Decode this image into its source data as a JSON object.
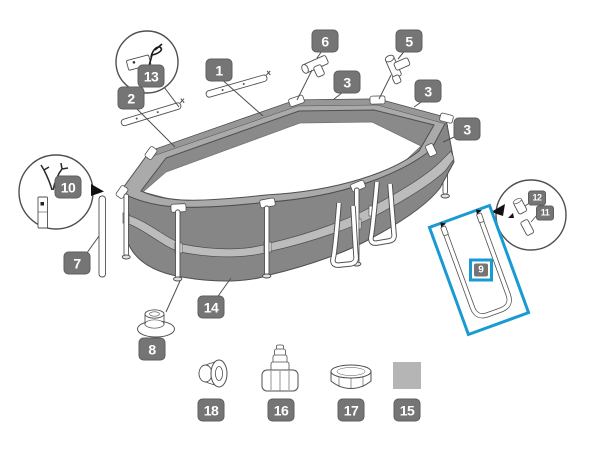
{
  "diagram": {
    "subject": "oval-frame-pool-exploded-parts-diagram",
    "background_color": "#ffffff",
    "badge_color": "#757575",
    "badge_text_color": "#ffffff",
    "line_color": "#4f4f4f",
    "wall_color": "#868686",
    "rail_color": "#aaaaaa",
    "band_color": "#bcbcbc",
    "patch_color": "#b5b5b5",
    "highlight_color": "#1a9ad2",
    "highlighted_part": "9",
    "callouts": {
      "c1": {
        "label": "1"
      },
      "c2": {
        "label": "2"
      },
      "c3a": {
        "label": "3"
      },
      "c3b": {
        "label": "3"
      },
      "c3c": {
        "label": "3"
      },
      "c5": {
        "label": "5"
      },
      "c6": {
        "label": "6"
      },
      "c7": {
        "label": "7"
      },
      "c8": {
        "label": "8"
      },
      "c9": {
        "label": "9"
      },
      "c10": {
        "label": "10"
      },
      "c11": {
        "label": "11"
      },
      "c12": {
        "label": "12"
      },
      "c13": {
        "label": "13"
      },
      "c14": {
        "label": "14"
      },
      "c15": {
        "label": "15"
      },
      "c16": {
        "label": "16"
      },
      "c17": {
        "label": "17"
      },
      "c18": {
        "label": "18"
      }
    }
  }
}
